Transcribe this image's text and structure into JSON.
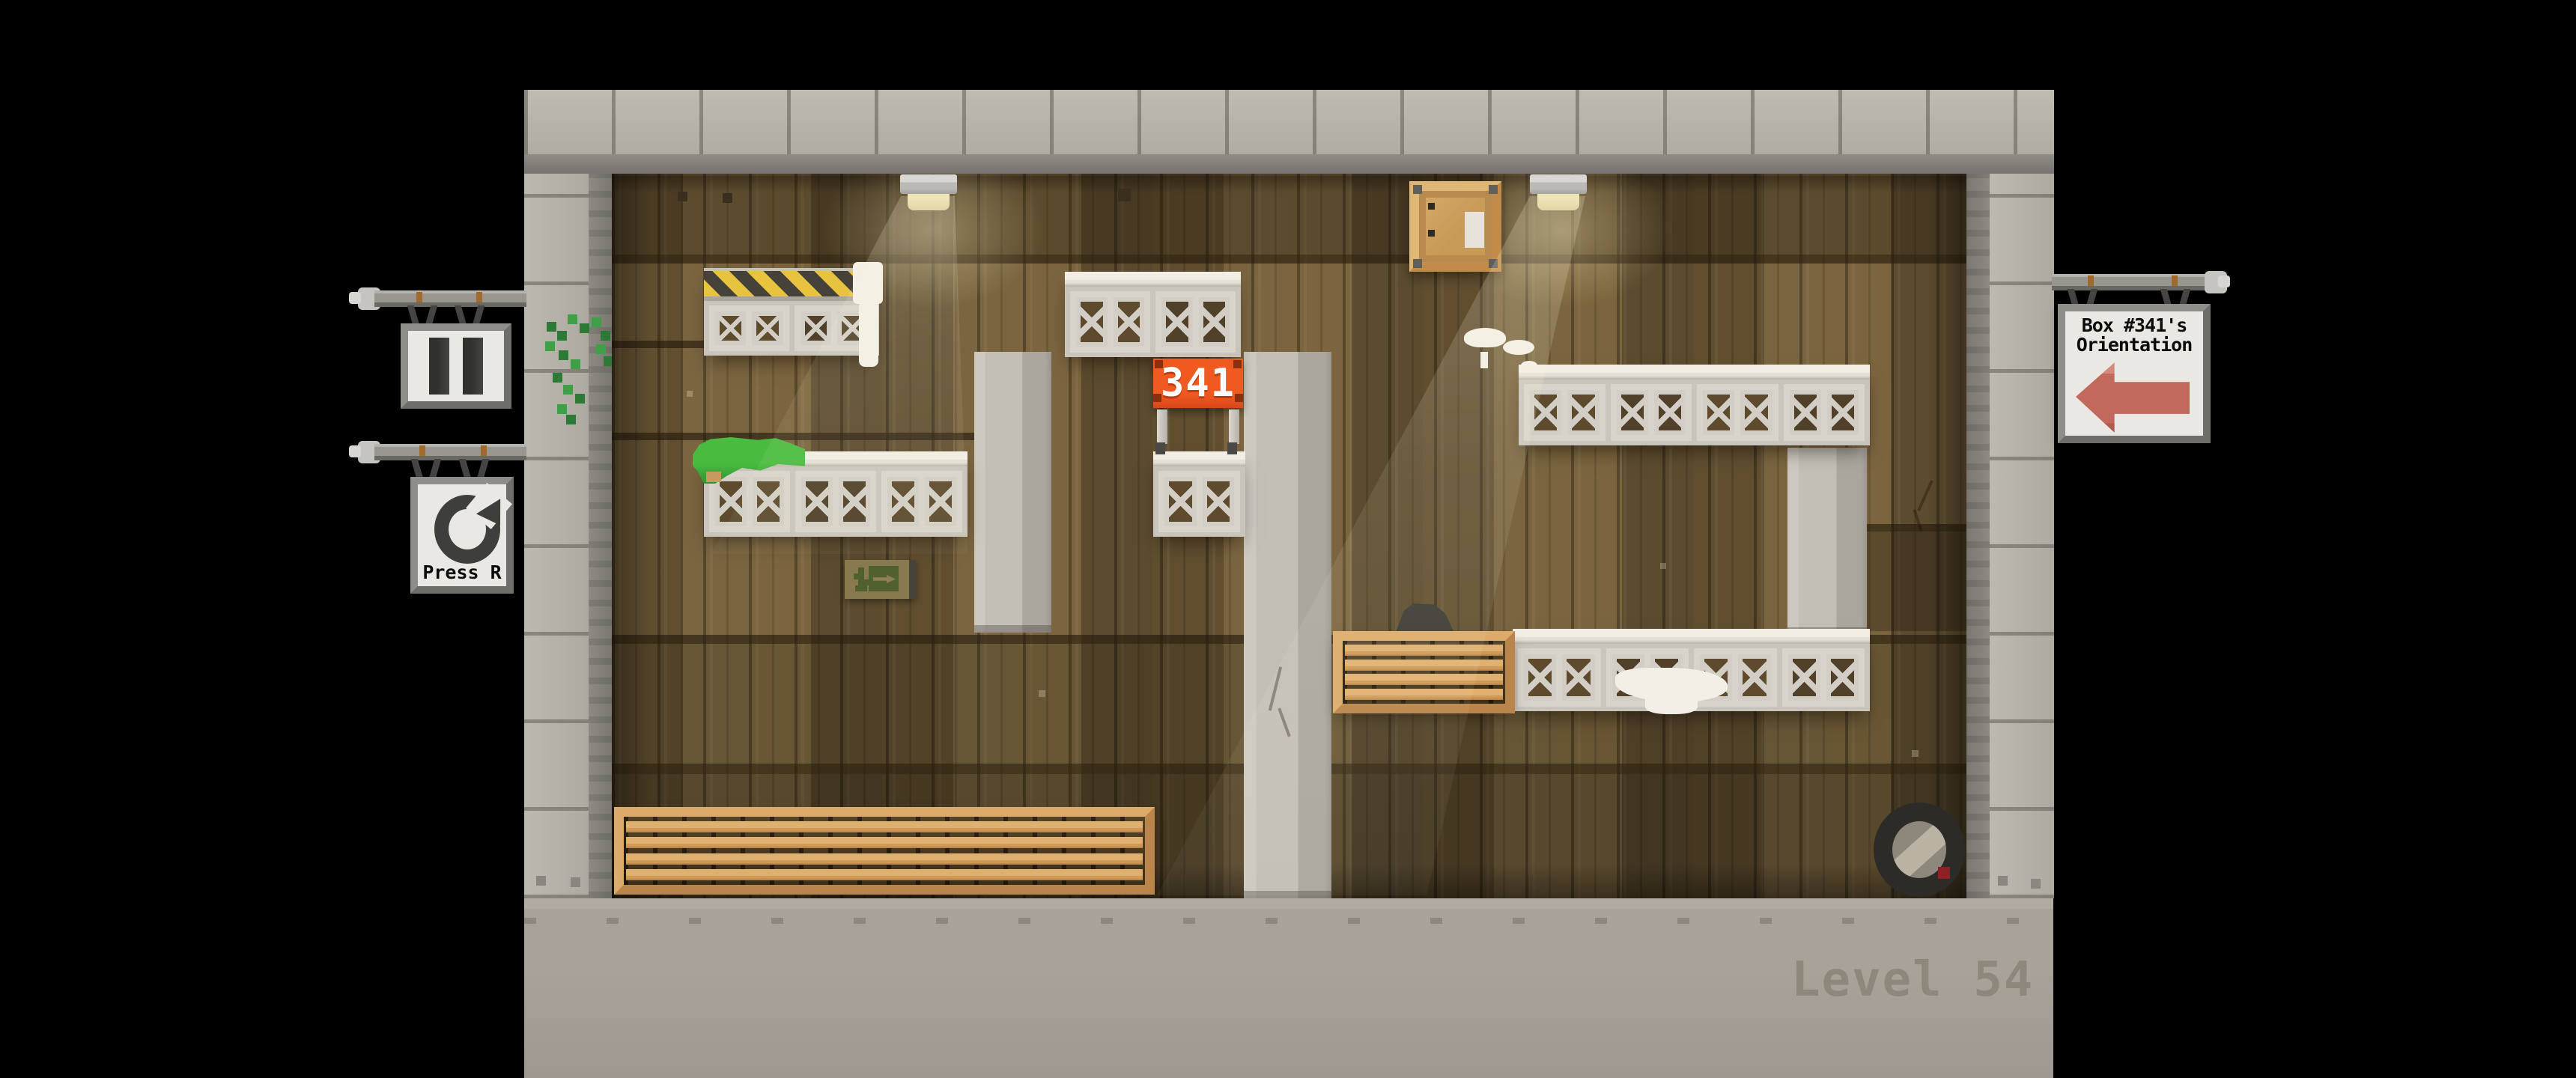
{
  "hud": {
    "level_label": "Level 54"
  },
  "signs": {
    "pause": {
      "icon": "pause-bars"
    },
    "restart": {
      "icon": "restart-circular-arrow",
      "label": "Press R"
    },
    "orientation": {
      "title_line1": "Box #341's",
      "title_line2": "Orientation",
      "arrow_direction": "left"
    }
  },
  "objects": {
    "numbered_box": {
      "number": "341"
    },
    "exit_sign": {
      "symbol": "running-figure-with-right-arrow"
    },
    "crate": {
      "label": "blank-shipping-label"
    }
  },
  "colors": {
    "box_plate_orange": "#e8501e",
    "orientation_arrow_red": "#c2685c",
    "hazard_yellow": "#e7c33f",
    "grass_green": "#3fae3b",
    "wood_brown": "#7a6540",
    "floor_gray": "#a8a299",
    "level_text_gray": "#8d887b"
  }
}
